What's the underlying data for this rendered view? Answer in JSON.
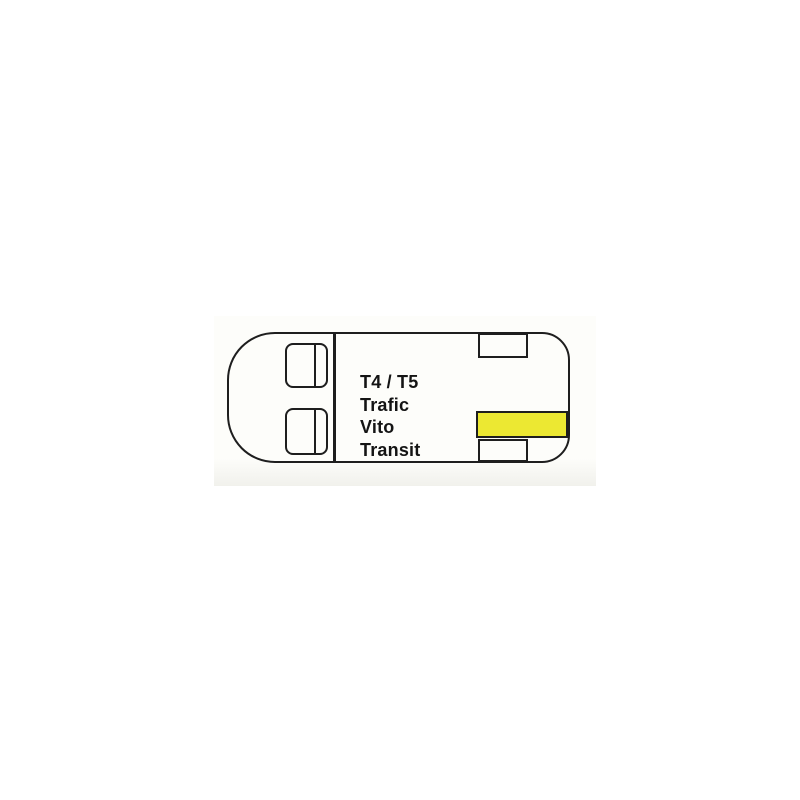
{
  "diagram": {
    "description": "van-top-view-compatibility-diagram",
    "labels": [
      "T4 / T5",
      "Trafic",
      "Vito",
      "Transit"
    ],
    "highlight_color": "#ece832",
    "line_color": "#1e1e1e",
    "background_color": "#ffffff"
  }
}
